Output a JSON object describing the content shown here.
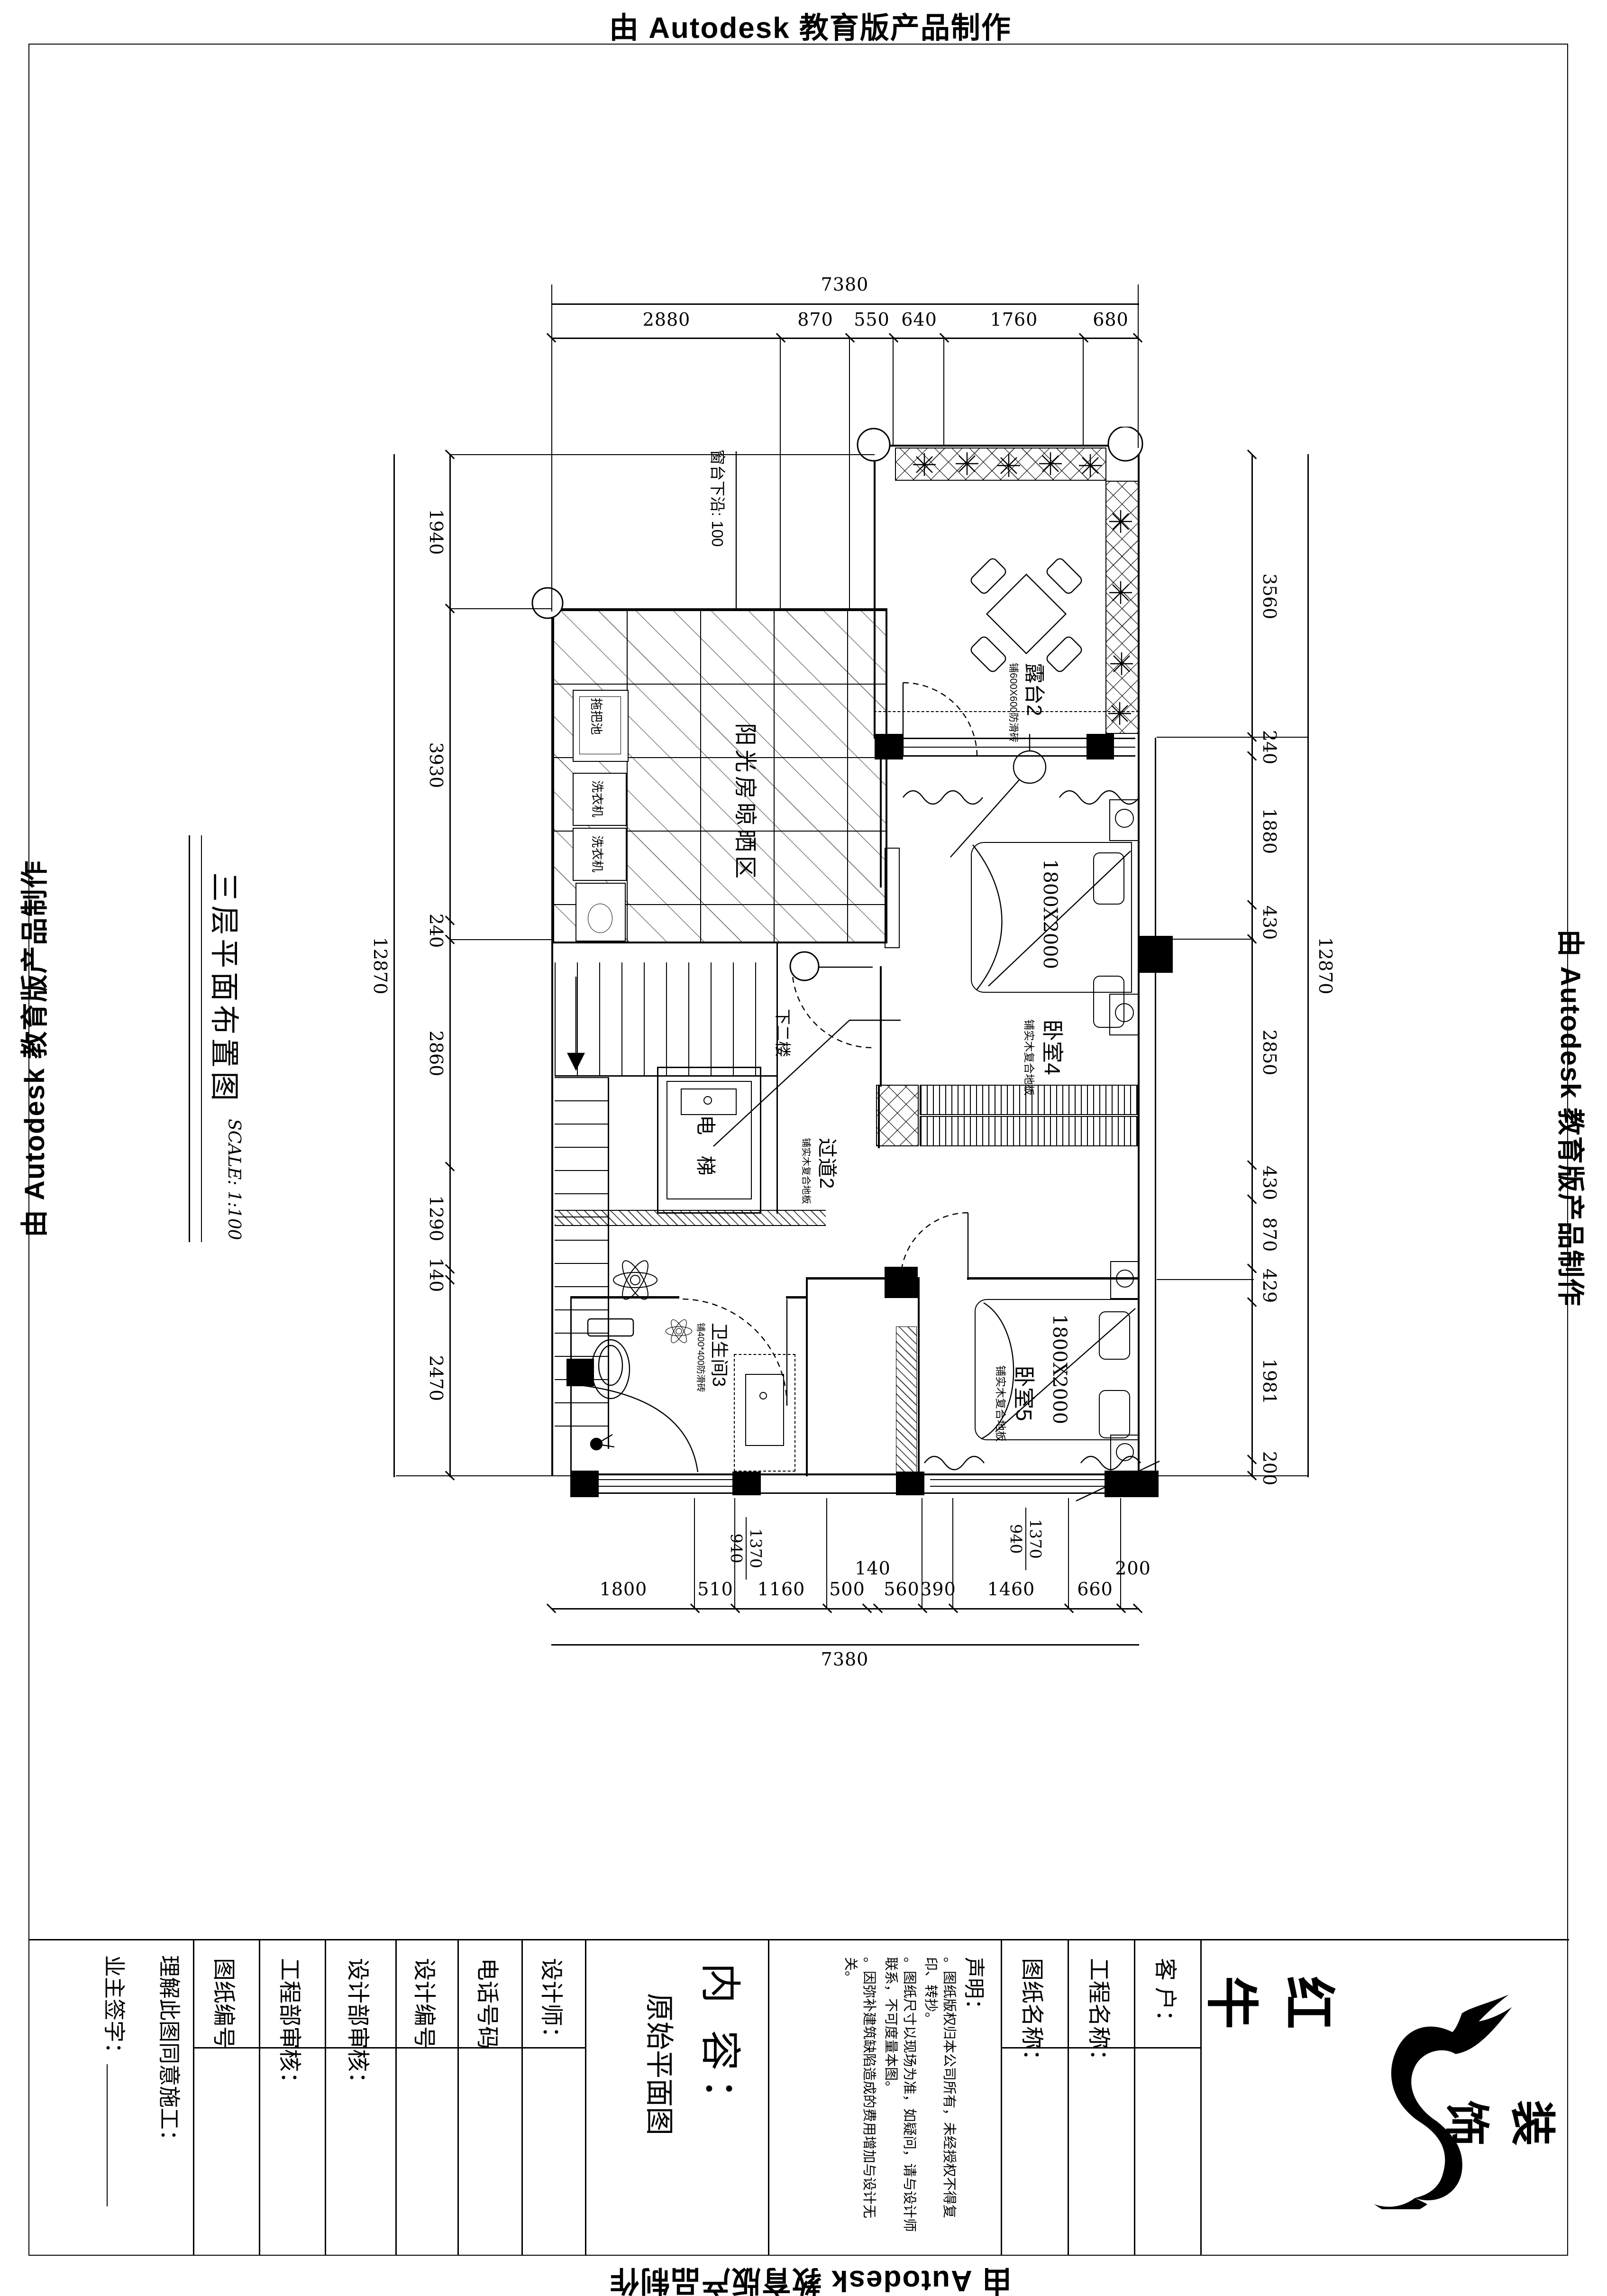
{
  "edge": {
    "top": "由 Autodesk 教育版产品制作",
    "right": "由 Autodesk 教育版产品制作",
    "left": "由 Autodesk 教育版产品制作",
    "bottom": "由 Autodesk 教育版产品制作"
  },
  "title": {
    "name": "三层平面布置图",
    "scale": "SCALE: 1:100"
  },
  "rooms": {
    "sunroom": "阳光房晾晒区",
    "terrace": "露台2",
    "terrace_note": "铺600X600防滑砖",
    "bedroom4": "卧室4",
    "bedroom4_note": "铺实木复合地板",
    "bedroom4_bed": "1800X2000",
    "bedroom5": "卧室5",
    "bedroom5_note": "铺实木复合地板",
    "bedroom5_bed": "1800X2000",
    "corridor": "过道2",
    "corridor_note": "铺实木复合地板",
    "bathroom": "卫生间3",
    "bathroom_note": "铺400*400防滑砖",
    "elevator": "电 梯",
    "stairs": "下二楼",
    "sill": "窗台下沿: 100",
    "mop_sink": "拖把池",
    "washer": "洗衣机"
  },
  "window_tags": {
    "w1_top": "1370",
    "w1_bottom": "940",
    "w2_top": "1370",
    "w2_bottom": "940"
  },
  "dimensions": {
    "top": {
      "total": "7380",
      "segments": [
        "2880",
        "870",
        "550",
        "640",
        "1760",
        "680"
      ]
    },
    "bottom": {
      "total": "7380",
      "segments": [
        "1800",
        "510",
        "1160",
        "500",
        "140",
        "560",
        "390",
        "1460",
        "660",
        "200"
      ]
    },
    "left": {
      "total": "12870",
      "segments": [
        "1940",
        "3930",
        "240",
        "2860",
        "1290",
        "140",
        "2470"
      ]
    },
    "right": {
      "total": "12870",
      "segments": [
        "3560",
        "240",
        "1880",
        "430",
        "2850",
        "430",
        "870",
        "429",
        "1981",
        "200"
      ]
    }
  },
  "titleblock": {
    "agree": "理解此图同意施工：",
    "owner": "业主签字：",
    "c_sheet_no": "图纸编号",
    "c_eng_audit": "工程部审核：",
    "c_design_audit": "设计部审核：",
    "c_design_no": "设计编号",
    "c_phone": "电话号码",
    "c_designer": "设计师：",
    "content_label": "内 容：",
    "content_value": "原始平面图",
    "stmt_title": "声明：",
    "stmt_items": [
      "。图纸版权归本公司所有，未经授权不得复印、转抄。",
      "。图纸尺寸以现场为准，如疑问，请与设计师联系，不可度量本图。",
      "。因弥补建筑缺陷造成的费用增加与设计无关。"
    ],
    "c_sheet_name": "图纸名称：",
    "c_project_name": "工程名称：",
    "c_client": "客  户：",
    "logo_name": "红 牛",
    "logo_suffix": "装 饰"
  }
}
